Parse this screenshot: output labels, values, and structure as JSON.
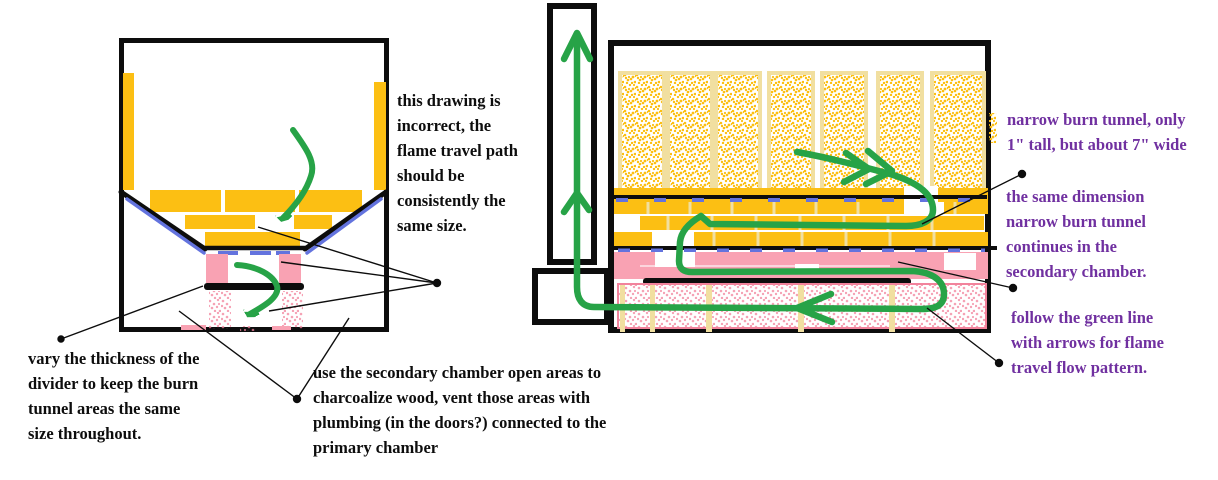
{
  "colors": {
    "ink": "#0d0d0d",
    "gold": "#fcbf13",
    "cream": "#f1dfa0",
    "pink": "#f9a2b3",
    "pinkline": "#f2839c",
    "blue": "#6373de",
    "green": "#27a347",
    "purple": "#7030a0"
  },
  "notes": {
    "incorrect": {
      "lines": [
        "this drawing is",
        "incorrect, the",
        "flame travel path",
        "should be",
        "consistently the",
        "same size."
      ]
    },
    "vary_divider": {
      "lines": [
        "vary the thickness of the",
        "divider to keep the burn",
        "tunnel areas the same",
        "size throughout."
      ]
    },
    "secondary_chamber": {
      "lines": [
        "use the secondary chamber open areas to",
        "charcoalize wood, vent those areas with",
        "plumbing (in the doors?) connected to the",
        "primary chamber"
      ]
    },
    "narrow_tunnel": {
      "lines": [
        "narrow burn tunnel, only",
        "1\" tall, but about 7\" wide"
      ]
    },
    "same_dimension": {
      "lines": [
        "the same dimension",
        "narrow burn tunnel",
        "continues in the",
        "secondary chamber."
      ]
    },
    "follow_green": {
      "lines": [
        "follow the green line",
        "with arrows for flame",
        "travel flow pattern."
      ]
    }
  }
}
